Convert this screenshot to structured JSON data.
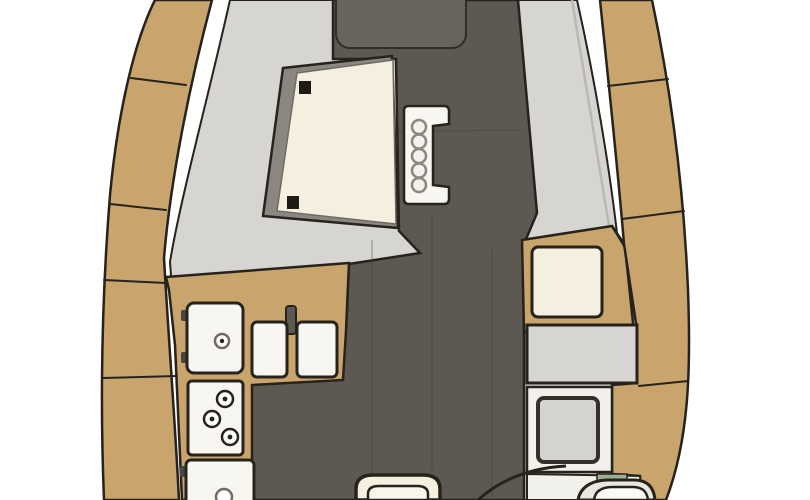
{
  "diagram": {
    "kind": "sailing-yacht-interior-floor-plan",
    "view": "top-down mid-section, stern toward top, bow toward bottom",
    "components": {
      "left_side_deck": "port side deck",
      "right_side_deck": "starboard side deck",
      "saloon": "saloon seating area",
      "cabin_sole": "dark walkway floor",
      "saloon_table": "fold-out saloon table with hinges",
      "companionway_steps": "companionway ladder with five treads",
      "galley": "L-shaped galley counter",
      "galley_sink_unit": "top-loading locker with drain",
      "double_sink": "twin square sinks with faucet",
      "stove": "three-burner stove",
      "oven": "oven / front-opening locker",
      "nav_cabinet": "navigation cabinet",
      "nav_seat": "navigator seat cushion",
      "chart_table": "chart table",
      "head": "head compartment with shower tray and sink",
      "head_door": "door swing arc",
      "forward_berth": "forward berth (partial, cut off)"
    }
  },
  "palette": {
    "background": "#ffffff",
    "tan": "#c9a46c",
    "floor_dark": "#5d5952",
    "floor_light": "#68645d",
    "gray_light": "#d6d5d1",
    "gray_mid": "#8b8780",
    "cream": "#f4efdf",
    "fixture_white": "#f7f6f1",
    "head_white": "#f1f0eb",
    "shower_gray": "#d4d3cf",
    "sage": "#9fae94",
    "hinge_dark": "#1e1a15",
    "outline": "#26221c"
  }
}
